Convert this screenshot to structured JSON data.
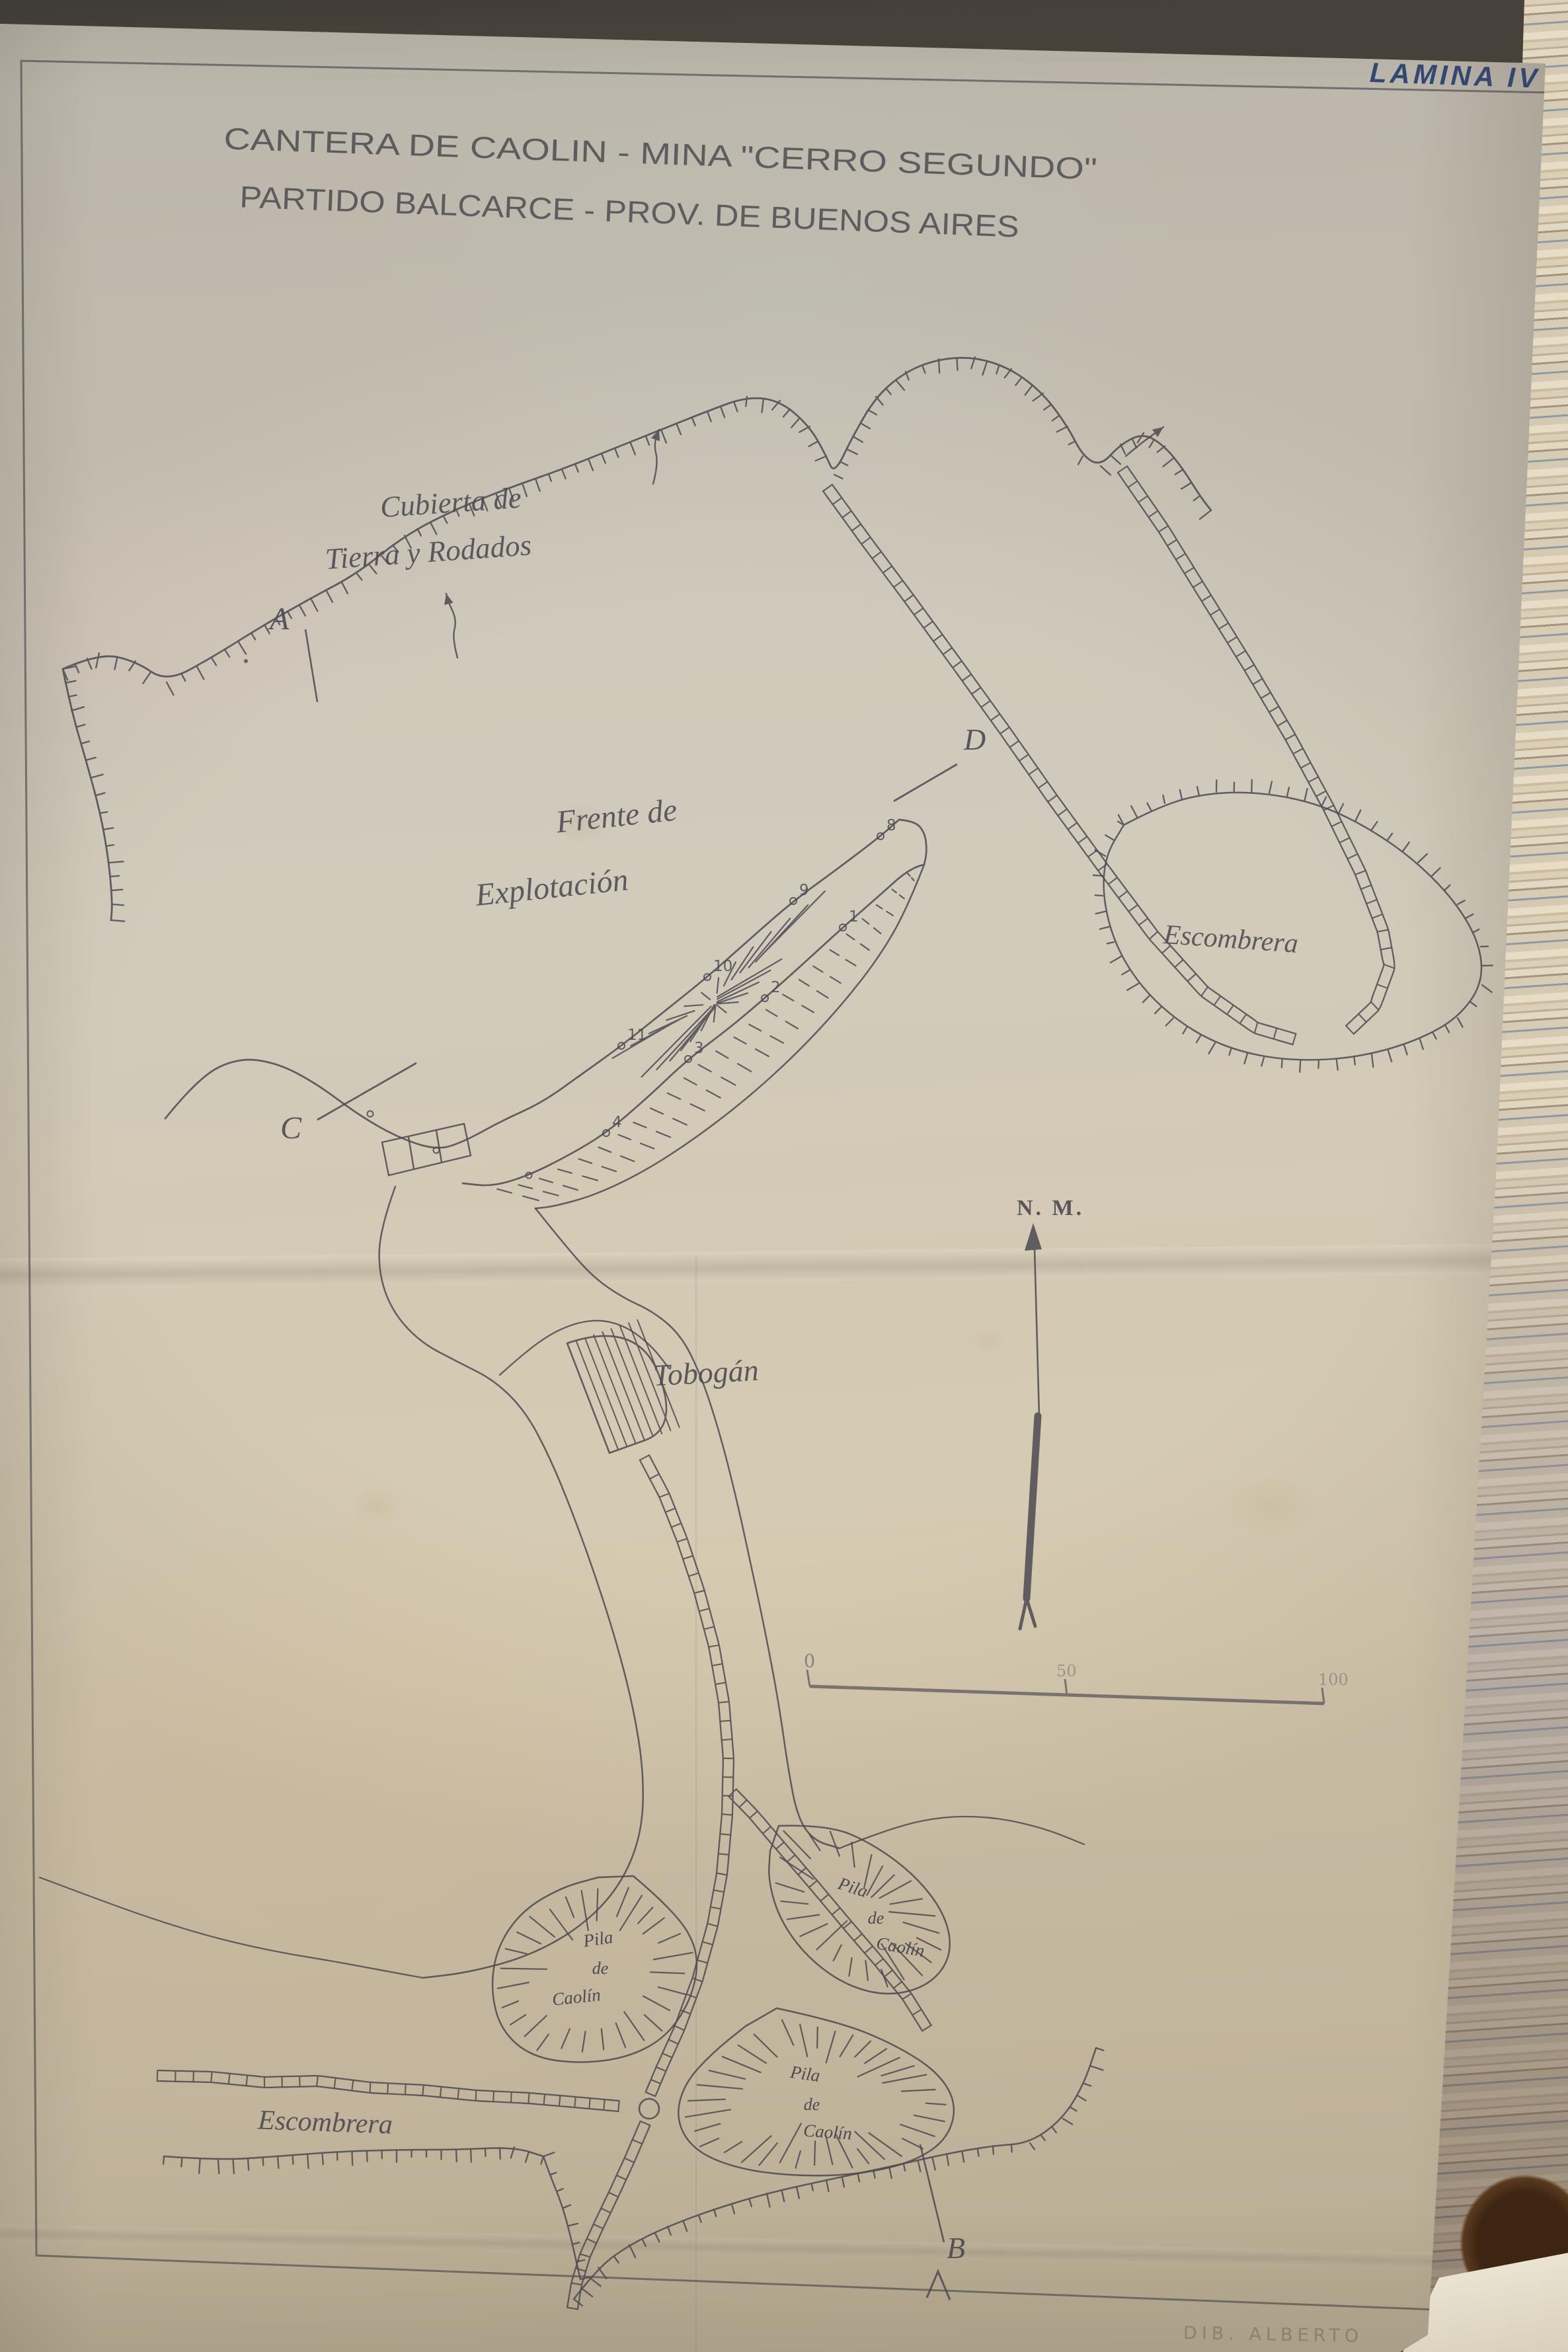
{
  "plate": {
    "stamp": "LAMINA IV"
  },
  "title": {
    "line1": "CANTERA  DE  CAOLIN - MINA  \"CERRO  SEGUNDO\"",
    "line2": "PARTIDO  BALCARCE - PROV.  DE  BUENOS  AIRES"
  },
  "labels": {
    "cover1": "Cubierta de",
    "cover2": "Tierra y Rodados",
    "front1": "Frente de",
    "front2": "Explotación",
    "escombrera_right": "Escombrera",
    "escombrera_bottom": "Escombrera",
    "tobogan": "Tobogán",
    "north": "N. M."
  },
  "pile_label": {
    "l1": "Pila",
    "l2": "de",
    "l3": "Caolín"
  },
  "markers": {
    "a": "A",
    "b": "B",
    "c": "C",
    "d": "D"
  },
  "scale_bar": {
    "ticks": [
      "0",
      "50",
      "100"
    ]
  },
  "survey_points": {
    "labels": [
      "8",
      "9",
      "10",
      "11",
      "1",
      "2",
      "3",
      "4"
    ]
  },
  "stamp_bottom": "DIB. ALBERTO"
}
